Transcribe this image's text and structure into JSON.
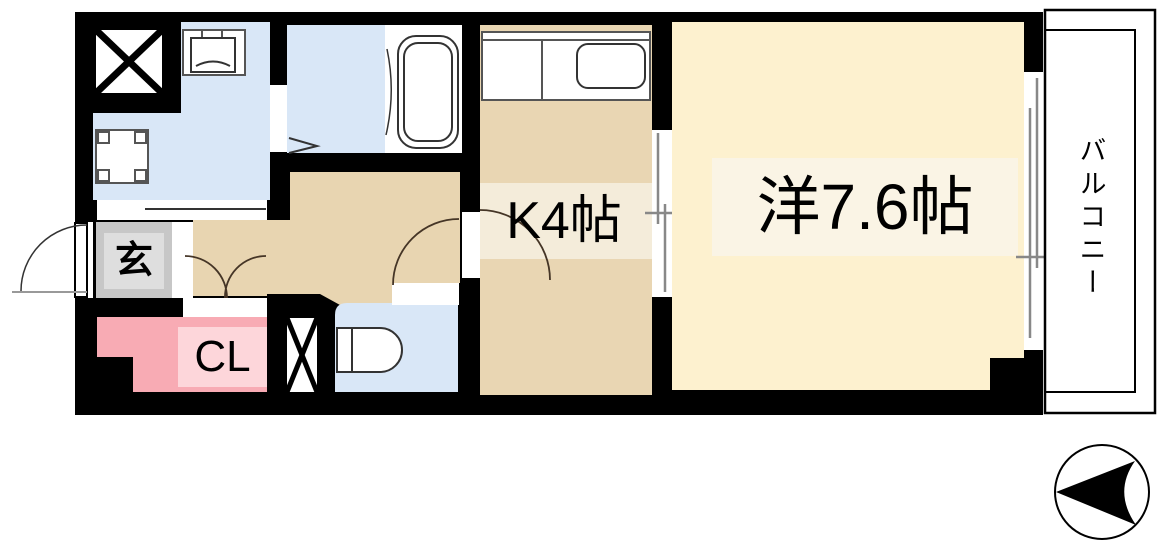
{
  "plan": {
    "title": "apartment-floorplan",
    "rooms": {
      "entrance": {
        "label": "玄"
      },
      "closet": {
        "label": "CL"
      },
      "kitchen": {
        "label": "K4帖"
      },
      "western_room": {
        "label": "洋7.6帖"
      },
      "balcony": {
        "label": "バルコニー"
      }
    },
    "colors": {
      "wall": "#000000",
      "wet_area": "#d9e7f7",
      "hall": "#e8d5b1",
      "kitchen": "#e9d6b3",
      "kitchen_label_bg": "#f4ecda",
      "room": "#fdf1cf",
      "room_label_bg": "#faf4e5",
      "closet": "#f8abb4",
      "closet_label_bg": "#fdd6da",
      "entrance": "#c7c7c7",
      "entrance_label_bg": "#dedede",
      "fixture_fill": "#ffffff",
      "door_gap": "#ffffff",
      "window_line": "#888888",
      "door_arc": "#453526",
      "outline": "#333333"
    },
    "icons": {
      "shaft": "shaft-x-icon",
      "pipe_space": "pipe-space-x-icon",
      "washbasin": "washbasin-icon",
      "washing_machine_pan": "washing-machine-pan-icon",
      "bathtub": "bathtub-icon",
      "toilet": "toilet-icon",
      "kitchen_sink": "kitchen-sink-icon",
      "north_arrow": "north-arrow-icon"
    }
  }
}
